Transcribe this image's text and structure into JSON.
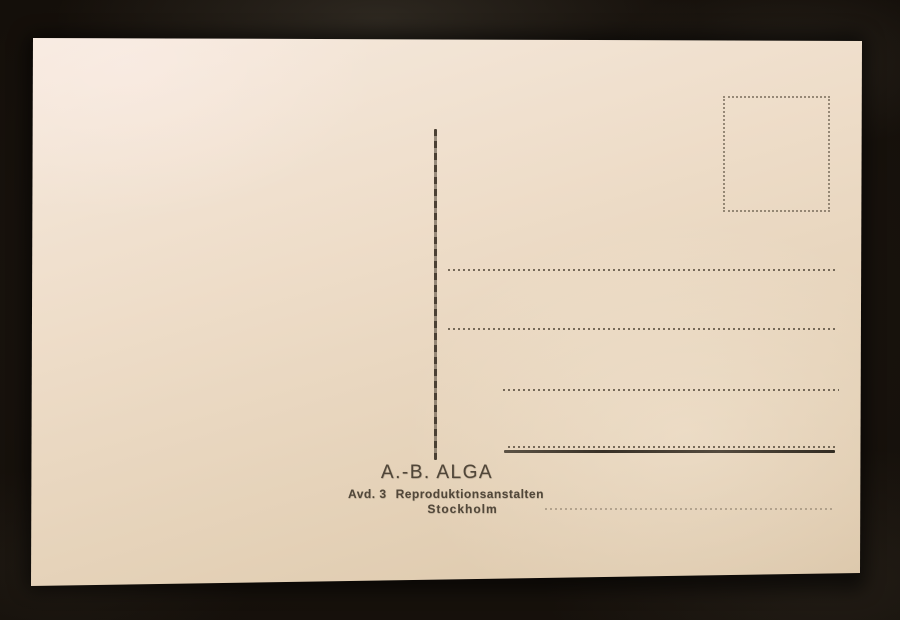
{
  "postcard": {
    "imprint": {
      "line1": "A.-B. ALGA",
      "line2_label": "Avd. 3",
      "line2_text": "Reproduktionsanstalten",
      "line3": "Stockholm"
    },
    "colors": {
      "paper_light": "#f6eadf",
      "paper_dark": "#dbc6a9",
      "ink": "#4a4033",
      "dotted_line": "#584d3e",
      "leather_background": "#161109"
    }
  }
}
